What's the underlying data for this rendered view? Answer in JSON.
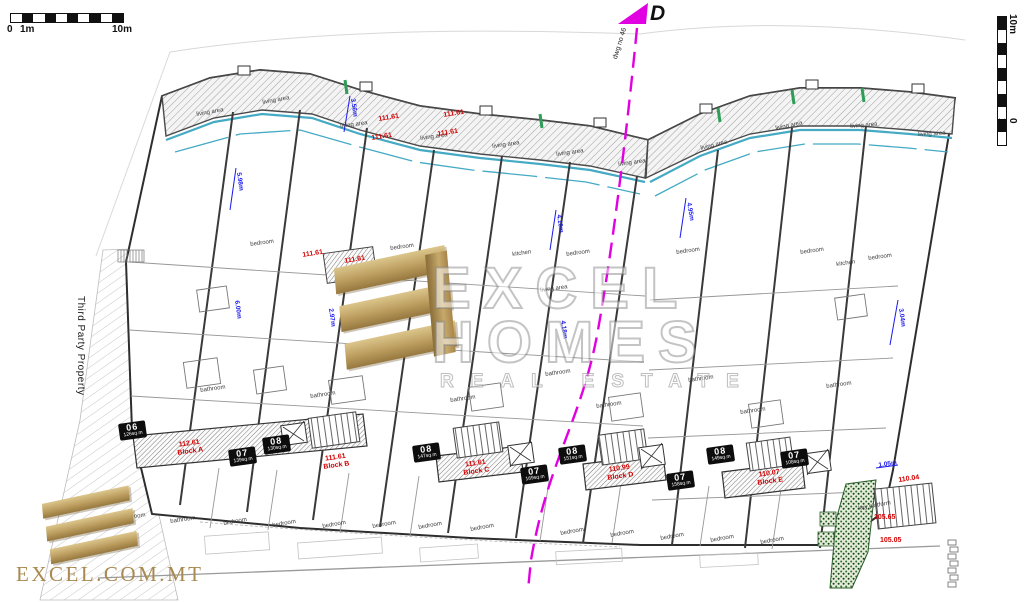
{
  "scalebar_top": {
    "zero": "0",
    "one": "1m",
    "ten": "10m"
  },
  "scalebar_right": {
    "top": "10m",
    "bottom": "0 1m"
  },
  "section_marker": {
    "label": "D",
    "dwg_no": "dwg no 46"
  },
  "left_boundary": {
    "label": "Third Party Property"
  },
  "watermark": {
    "line1": "EXCEL",
    "line2": "HOMES",
    "line3": "REAL ESTATE"
  },
  "brand": {
    "site": "EXCEL.COM.MT"
  },
  "colors": {
    "section_magenta": "#e100e1",
    "level_red": "#d40000",
    "dimension_blue": "#1a1aee",
    "glass_cyan": "#45aac4",
    "brand_gold": "#bb9c5e",
    "planting_green": "#2f6f2f"
  },
  "levels": [
    {
      "text": "111.61",
      "x": 378,
      "y": 116,
      "rot": -9
    },
    {
      "text": "111.61",
      "x": 443,
      "y": 112,
      "rot": -9
    },
    {
      "text": "111.61",
      "x": 371,
      "y": 135,
      "rot": -9
    },
    {
      "text": "111.61",
      "x": 437,
      "y": 131,
      "rot": -9
    },
    {
      "text": "111.61",
      "x": 302,
      "y": 252,
      "rot": -9
    },
    {
      "text": "111.61",
      "x": 344,
      "y": 258,
      "rot": -9
    },
    {
      "text": "110.04",
      "x": 898,
      "y": 477,
      "rot": -8
    },
    {
      "text": "105.65",
      "x": 874,
      "y": 514,
      "rot": 0
    },
    {
      "text": "105.05",
      "x": 880,
      "y": 537,
      "rot": 0
    }
  ],
  "blocks": [
    {
      "level": "112.61",
      "name": "Block A",
      "x": 176,
      "y": 442,
      "rot": -8
    },
    {
      "level": "111.61",
      "name": "Block B",
      "x": 322,
      "y": 456,
      "rot": -8
    },
    {
      "level": "111.61",
      "name": "Block C",
      "x": 462,
      "y": 462,
      "rot": -8
    },
    {
      "level": "110.99",
      "name": "Block D",
      "x": 606,
      "y": 467,
      "rot": -8
    },
    {
      "level": "110.07",
      "name": "Block E",
      "x": 756,
      "y": 472,
      "rot": -8
    }
  ],
  "badges": [
    {
      "no": "06",
      "area": "126sq.m",
      "x": 118,
      "y": 424,
      "rot": -8
    },
    {
      "no": "07",
      "area": "139sq.m",
      "x": 228,
      "y": 450,
      "rot": -8
    },
    {
      "no": "08",
      "area": "130sq.m",
      "x": 262,
      "y": 438,
      "rot": -8
    },
    {
      "no": "08",
      "area": "147sq.m",
      "x": 412,
      "y": 446,
      "rot": -8
    },
    {
      "no": "07",
      "area": "169sq.m",
      "x": 520,
      "y": 468,
      "rot": -8
    },
    {
      "no": "08",
      "area": "151sq.m",
      "x": 558,
      "y": 448,
      "rot": -8
    },
    {
      "no": "07",
      "area": "158sq.m",
      "x": 666,
      "y": 474,
      "rot": -8
    },
    {
      "no": "08",
      "area": "149sq.m",
      "x": 706,
      "y": 448,
      "rot": -8
    },
    {
      "no": "07",
      "area": "108sq.m",
      "x": 780,
      "y": 452,
      "rot": -8
    }
  ],
  "rooms": [
    {
      "text": "living area",
      "x": 196,
      "y": 112,
      "rot": -10
    },
    {
      "text": "living area",
      "x": 262,
      "y": 100,
      "rot": -10
    },
    {
      "text": "living area",
      "x": 340,
      "y": 124,
      "rot": -8
    },
    {
      "text": "living area",
      "x": 420,
      "y": 136,
      "rot": -8
    },
    {
      "text": "living area",
      "x": 492,
      "y": 144,
      "rot": -8
    },
    {
      "text": "living area",
      "x": 556,
      "y": 152,
      "rot": -8
    },
    {
      "text": "living area",
      "x": 618,
      "y": 162,
      "rot": -8
    },
    {
      "text": "living area",
      "x": 700,
      "y": 146,
      "rot": -14
    },
    {
      "text": "living area",
      "x": 775,
      "y": 126,
      "rot": -12
    },
    {
      "text": "living area",
      "x": 850,
      "y": 124,
      "rot": -5
    },
    {
      "text": "living area",
      "x": 918,
      "y": 132,
      "rot": -3
    },
    {
      "text": "living area",
      "x": 540,
      "y": 288,
      "rot": -8
    },
    {
      "text": "bedroom",
      "x": 250,
      "y": 242,
      "rot": -8
    },
    {
      "text": "bedroom",
      "x": 390,
      "y": 246,
      "rot": -8
    },
    {
      "text": "bedroom",
      "x": 566,
      "y": 252,
      "rot": -8
    },
    {
      "text": "bedroom",
      "x": 676,
      "y": 250,
      "rot": -8
    },
    {
      "text": "bedroom",
      "x": 800,
      "y": 250,
      "rot": -8
    },
    {
      "text": "bedroom",
      "x": 868,
      "y": 256,
      "rot": -8
    },
    {
      "text": "bedroom",
      "x": 223,
      "y": 521,
      "rot": -10
    },
    {
      "text": "bedroom",
      "x": 272,
      "y": 523,
      "rot": -10
    },
    {
      "text": "bedroom",
      "x": 322,
      "y": 524,
      "rot": -10
    },
    {
      "text": "bedroom",
      "x": 372,
      "y": 524,
      "rot": -10
    },
    {
      "text": "bedroom",
      "x": 418,
      "y": 525,
      "rot": -10
    },
    {
      "text": "bedroom",
      "x": 470,
      "y": 527,
      "rot": -10
    },
    {
      "text": "bedroom",
      "x": 560,
      "y": 531,
      "rot": -10
    },
    {
      "text": "bedroom",
      "x": 610,
      "y": 533,
      "rot": -10
    },
    {
      "text": "bedroom",
      "x": 660,
      "y": 536,
      "rot": -10
    },
    {
      "text": "bedroom",
      "x": 710,
      "y": 538,
      "rot": -10
    },
    {
      "text": "bedroom",
      "x": 760,
      "y": 540,
      "rot": -10
    },
    {
      "text": "bathroom",
      "x": 120,
      "y": 516,
      "rot": -8
    },
    {
      "text": "bathroom",
      "x": 170,
      "y": 519,
      "rot": -8
    },
    {
      "text": "bathroom",
      "x": 200,
      "y": 388,
      "rot": -8
    },
    {
      "text": "bathroom",
      "x": 310,
      "y": 394,
      "rot": -8
    },
    {
      "text": "bathroom",
      "x": 450,
      "y": 398,
      "rot": -8
    },
    {
      "text": "bathroom",
      "x": 596,
      "y": 404,
      "rot": -8
    },
    {
      "text": "bathroom",
      "x": 740,
      "y": 410,
      "rot": -8
    },
    {
      "text": "bathroom",
      "x": 545,
      "y": 372,
      "rot": -8
    },
    {
      "text": "bathroom",
      "x": 688,
      "y": 378,
      "rot": -8
    },
    {
      "text": "bathroom",
      "x": 826,
      "y": 384,
      "rot": -8
    },
    {
      "text": "kitchen",
      "x": 512,
      "y": 252,
      "rot": -8
    },
    {
      "text": "kitchen",
      "x": 836,
      "y": 262,
      "rot": -8
    },
    {
      "text": "key platform",
      "x": 858,
      "y": 506,
      "rot": -10
    }
  ],
  "dims": [
    {
      "text": "3.56m",
      "x": 356,
      "y": 98,
      "rot": 82
    },
    {
      "text": "5.98m",
      "x": 242,
      "y": 172,
      "rot": 82
    },
    {
      "text": "6.00m",
      "x": 240,
      "y": 300,
      "rot": 82
    },
    {
      "text": "4.10m",
      "x": 562,
      "y": 214,
      "rot": 82
    },
    {
      "text": "4.18m",
      "x": 566,
      "y": 320,
      "rot": 82
    },
    {
      "text": "2.97m",
      "x": 334,
      "y": 308,
      "rot": 82
    },
    {
      "text": "4.95m",
      "x": 692,
      "y": 202,
      "rot": 80
    },
    {
      "text": "3.04m",
      "x": 904,
      "y": 308,
      "rot": 82
    },
    {
      "text": "1.05m",
      "x": 878,
      "y": 462,
      "rot": -8
    }
  ]
}
